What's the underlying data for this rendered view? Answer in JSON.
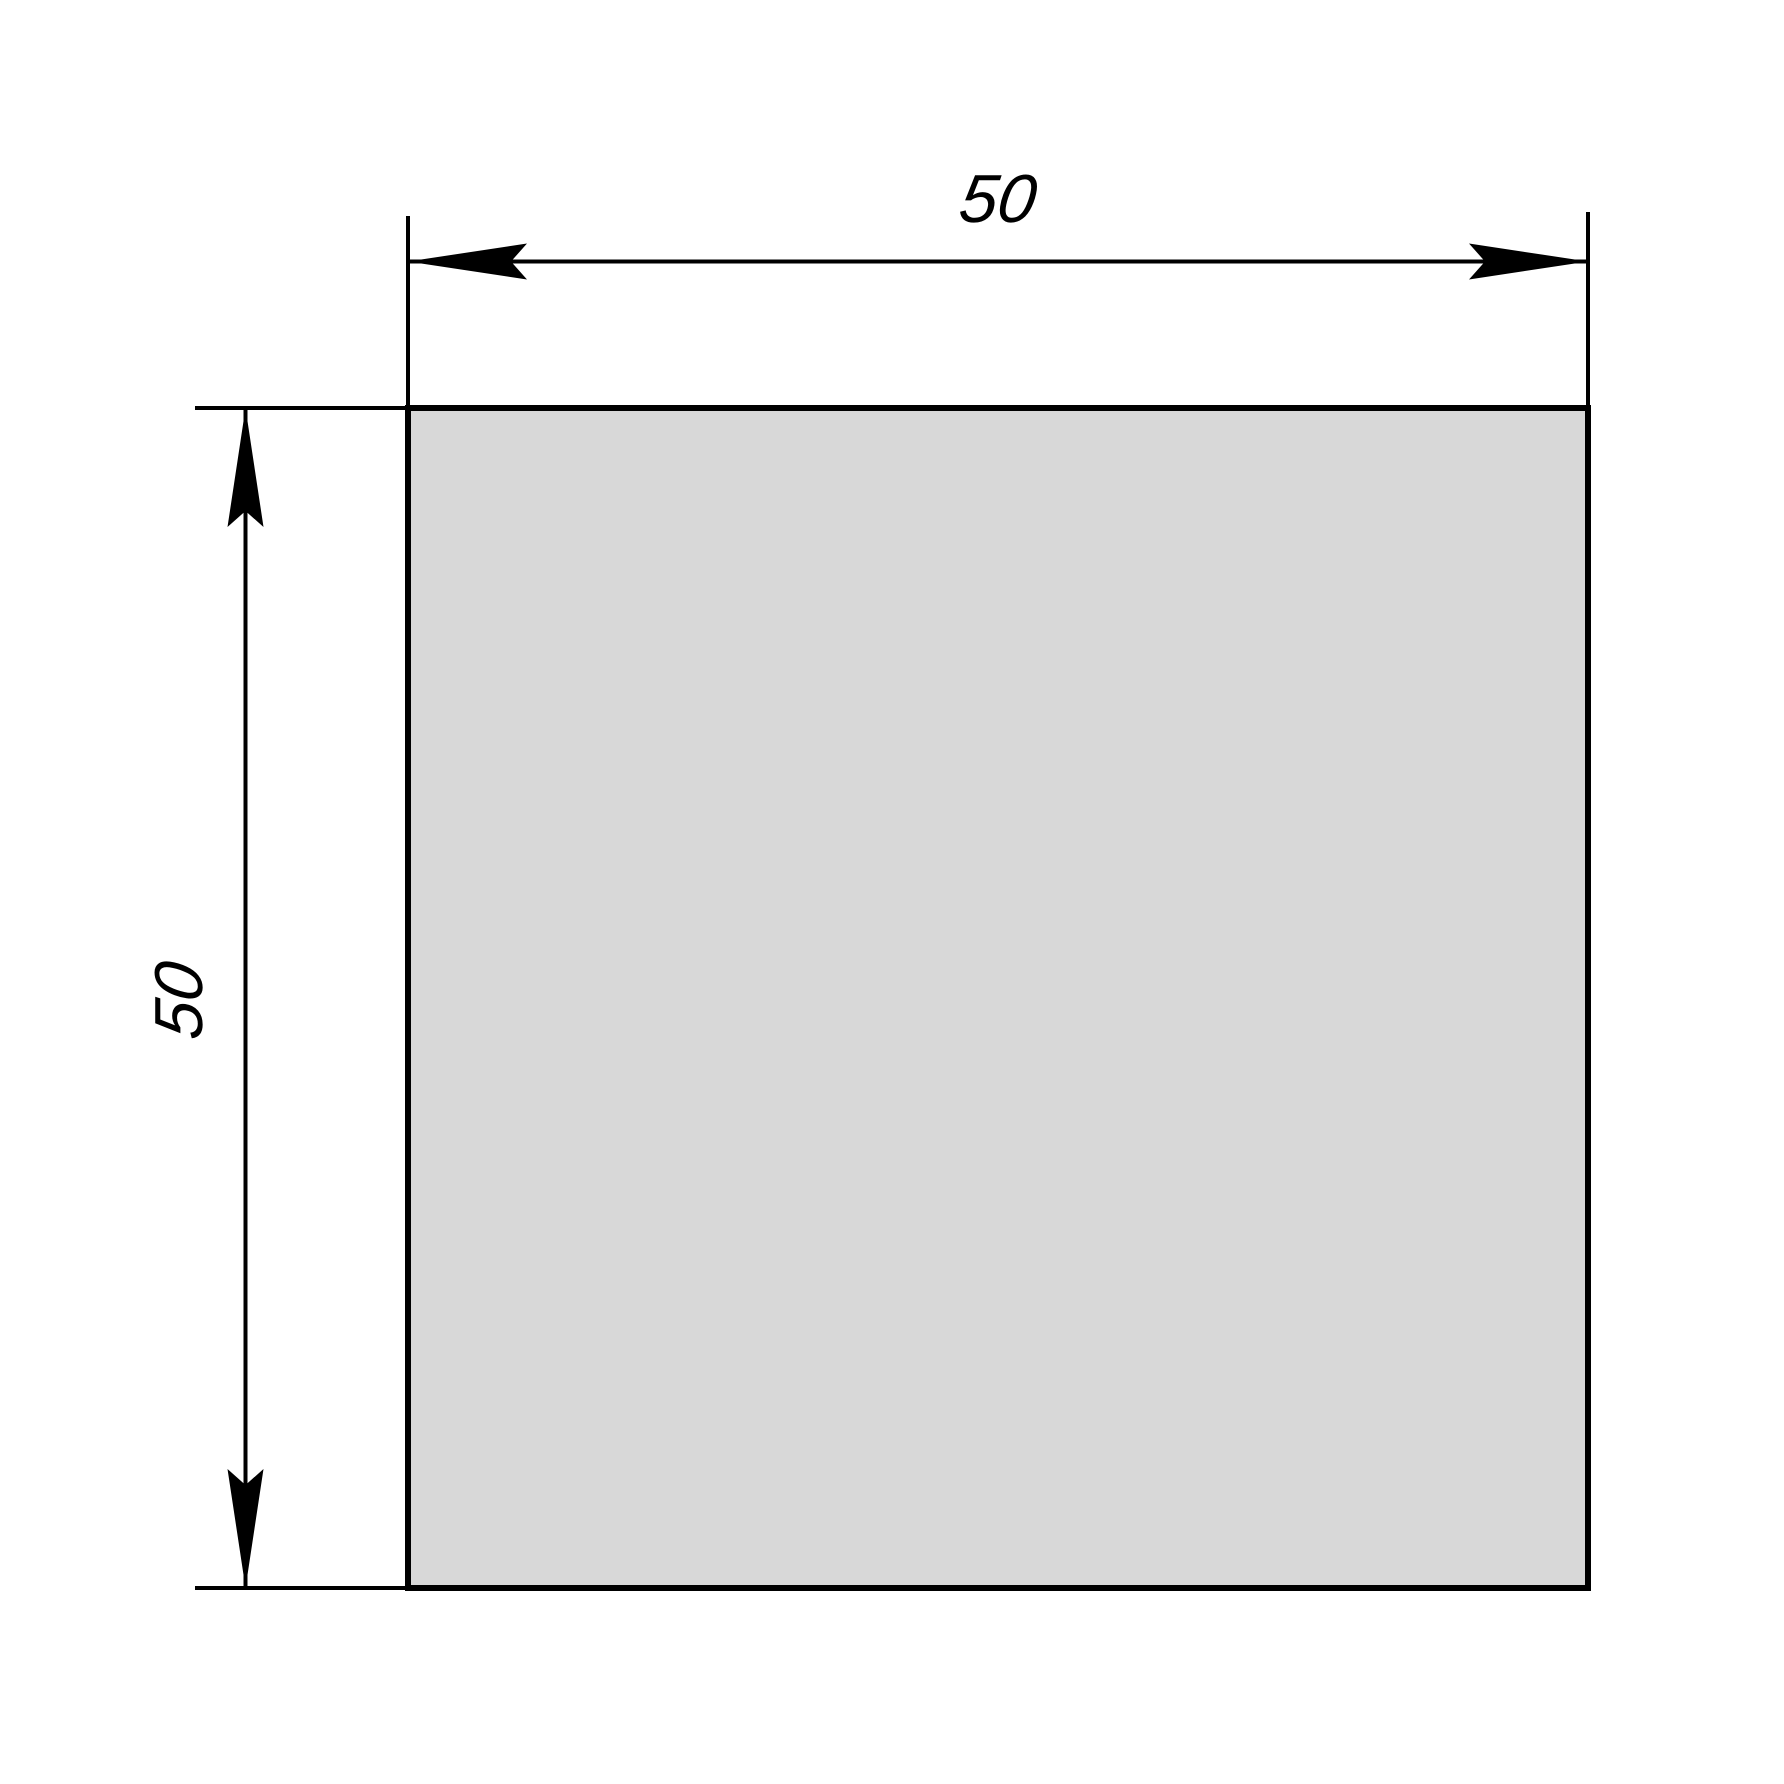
{
  "drawing": {
    "type": "technical-dimension-drawing",
    "shape": {
      "kind": "square",
      "fill": "#d8d8d8",
      "stroke": "#000000"
    },
    "colors": {
      "background": "#ffffff",
      "line": "#000000"
    },
    "dimensions": {
      "horizontal": {
        "label": "50"
      },
      "vertical": {
        "label": "50"
      }
    }
  }
}
